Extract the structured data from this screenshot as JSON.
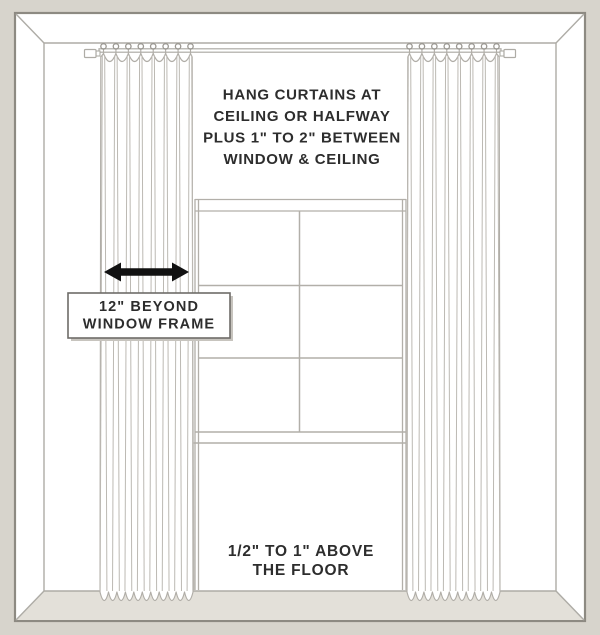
{
  "diagram": {
    "title_note_lines": [
      "HANG CURTAINS AT",
      "CEILING OR HALFWAY",
      "PLUS 1\" TO 2\" BETWEEN",
      "WINDOW & CEILING"
    ],
    "width_label_lines": [
      "12\" BEYOND",
      "WINDOW FRAME"
    ],
    "floor_note_lines": [
      "1/2\" TO 1\" ABOVE",
      "THE FLOOR"
    ],
    "colors": {
      "background": "#d7d4cc",
      "floor": "#e3e0d9",
      "wall": "#ffffff",
      "line": "#b0ada7",
      "fold_line": "#bcb9b3",
      "frame_border": "#8d8a82",
      "text": "#2d2d2d",
      "arrow": "#111111",
      "box_border": "#6e6c68",
      "box_shadow": "#c7c4be"
    }
  }
}
